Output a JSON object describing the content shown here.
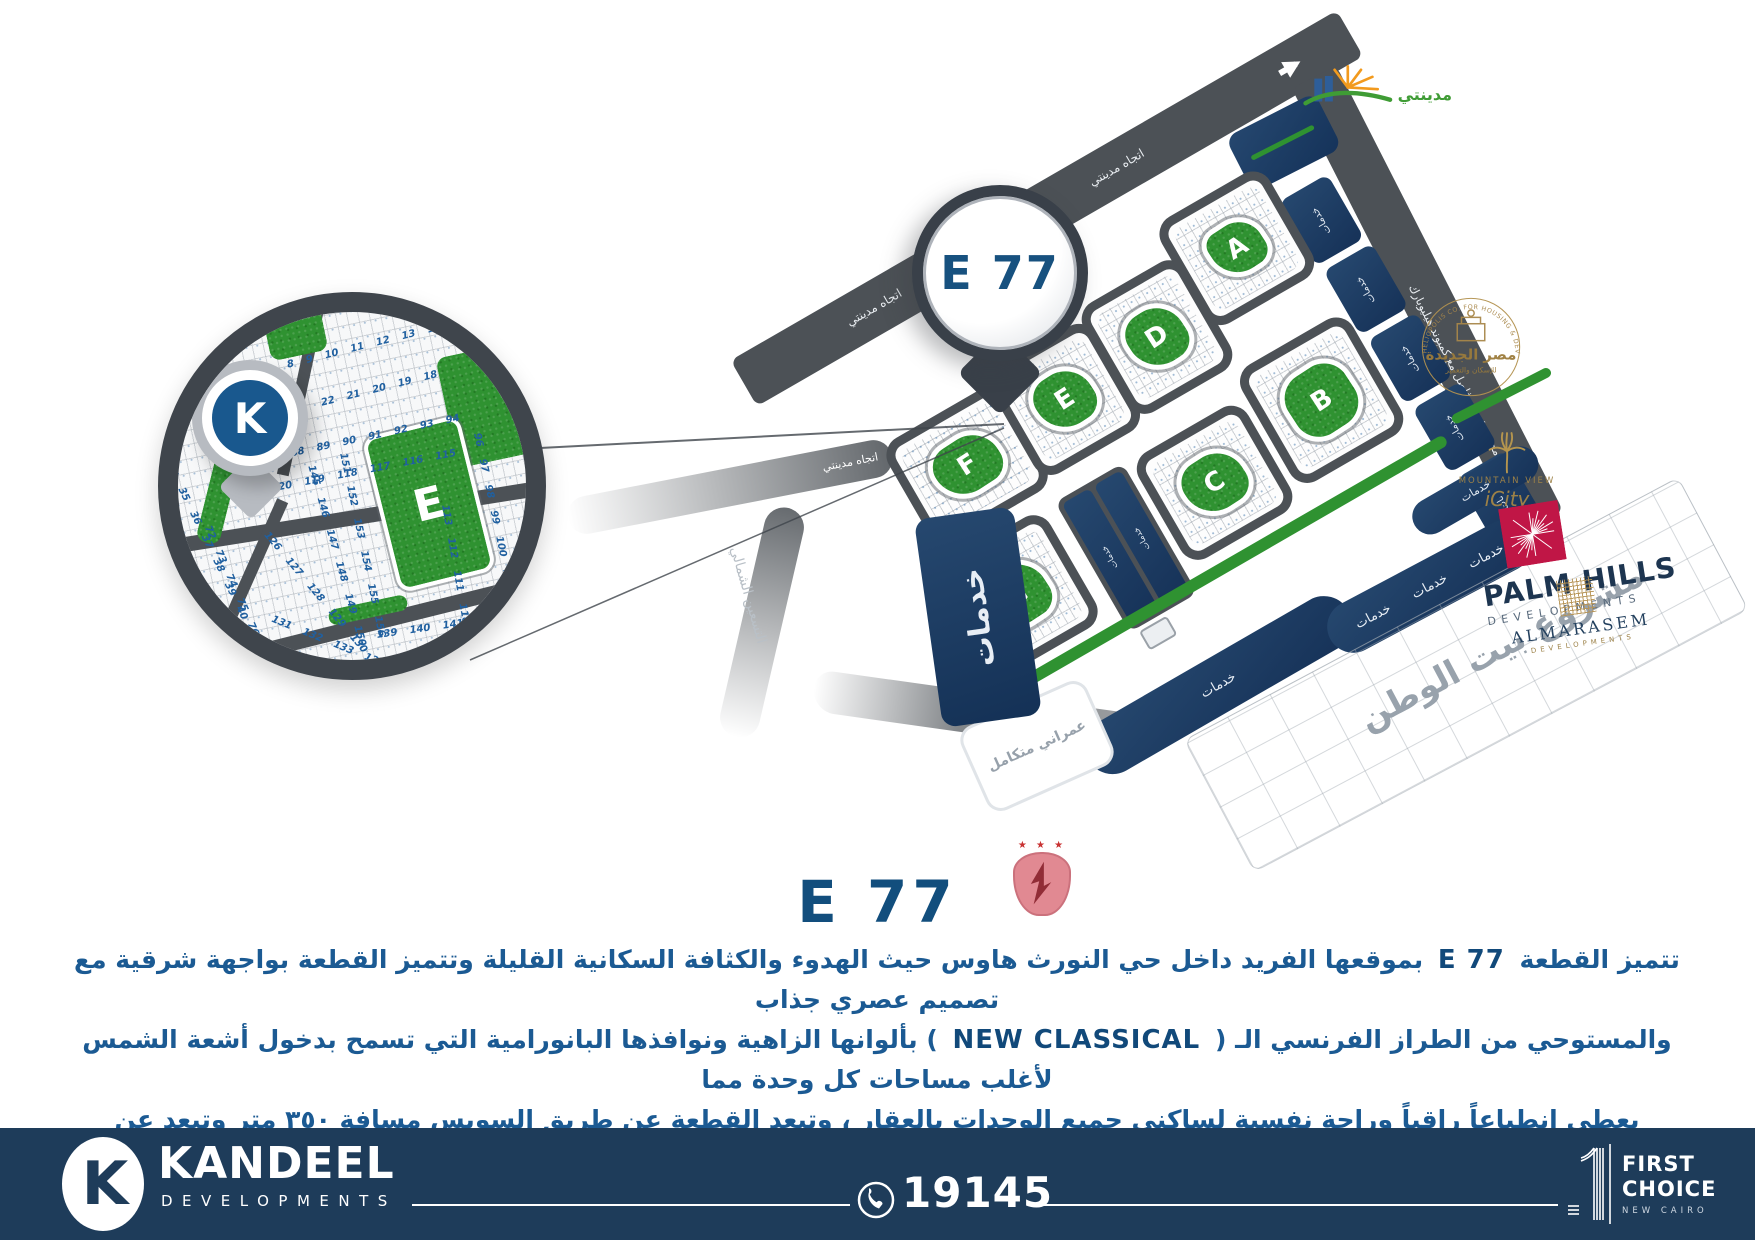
{
  "title": "E 77",
  "pin": {
    "label": "E 77"
  },
  "map": {
    "direction": "اتجاه مدينتي",
    "axis": "محور رئيسي فاصل مع كمبوند هيليوبارك",
    "north90": "التسعين الشمالي",
    "fateh": "محور الفتح اول",
    "services": "خدمات",
    "urban": "عمراني متكامل",
    "watan": "مشروع بيت الوطن",
    "blocks": {
      "a": "A",
      "b": "B",
      "c": "C",
      "d": "D",
      "e": "E",
      "f": "F",
      "g": "G"
    }
  },
  "inset": {
    "k": "K",
    "e": "E",
    "plot_rows": [
      "8 9 10 11 12 13 14 15 16 17",
      "22 21 20 19 18",
      "87 88 89 90 91 92 93 94",
      "121 120 119 118 117 116 115",
      "96 97 98 99 100 101",
      "113 112 111 110 109 108",
      "34 35 36 37 38 39 40",
      "72 73 74 75 76 77",
      "126 127 128 129 130",
      "151 152 153 154 155 156",
      "145 146 147 148 149 150",
      "131 132 133 134 135 136 137",
      "139 140 141 142 143 144"
    ]
  },
  "logos": {
    "madinaty_name": "مدينتي",
    "heliopolis": {
      "arc": "HELIOPOLIS CO. FOR HOUSING & DEVELOPMENT",
      "name_ar": "مصر الجديدة",
      "sub_ar": "للإسكان والتعمير"
    },
    "mountain_view": {
      "line1": "MOUNTAIN VIEW",
      "line2": "iCity"
    },
    "palm_hills": {
      "line1": "PALM HILLS",
      "line2": "DEVELOPMENTS"
    },
    "almarasem": {
      "line1": "ALMARASEM",
      "line2": "DEVELOPMENTS"
    },
    "ahly_stars": "★ ★ ★"
  },
  "description": {
    "line1_a": "تتميز القطعة",
    "line1_en": "E 77",
    "line1_b": "بموقعها الفريد داخل حي النورث هاوس حيث الهدوء والكثافة السكانية القليلة وتتميز القطعة بواجهة شرقية مع تصميم عصري جذاب",
    "line2_a": "والمستوحي من الطراز الفرنسي الـ (",
    "line2_en": "NEW CLASSICAL",
    "line2_b": ") بألوانها الزاهية ونوافذها البانورامية التي تسمح بدخول أشعة الشمس لأغلب مساحات كل وحدة مما",
    "line3": "يعطي إنطباعاً راقياً وراحة نفسية لساكني جميع الوحدات بالعقار ، وتبعد القطعة عن طريق السويس مسافة ٣٥٠ متر وتبعد عن منطقة الخدمات المركزية",
    "line4": "الخاصة بالحي مسافة ٦٥٠ متر وتبعد عن مدينة الرحاب والسوق الشرقي و النادي الأهلي ٦ دقائق بالسيارة"
  },
  "footer": {
    "k": "K",
    "brand": "KANDEEL",
    "brand_sub": "DEVELOPMENTS",
    "phone": "19145",
    "fc1": "FIRST",
    "fc2": "CHOICE",
    "fc3": "NEW CAIRO"
  },
  "colors": {
    "navy_services": "#1c3a60",
    "road_gray": "#4c5156",
    "park_green": "#2f9231",
    "footer_navy": "#1e3c5a",
    "text_blue": "#1b5a93",
    "palm_hills_red": "#c01646",
    "gold": "#b3924f"
  }
}
